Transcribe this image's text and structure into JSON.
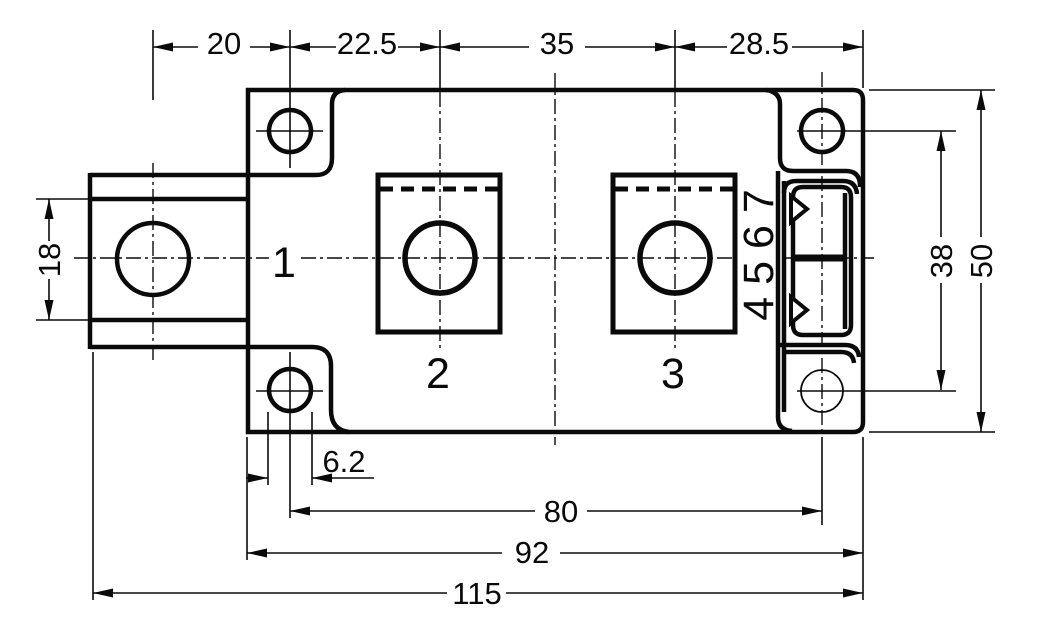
{
  "dimensions": {
    "top": {
      "d1": "20",
      "d2": "22.5",
      "d3": "35",
      "d4": "28.5"
    },
    "left": {
      "d1": "18"
    },
    "right": {
      "d1": "38",
      "d2": "50"
    },
    "bottom": {
      "d1": "6.2",
      "d2": "80",
      "d3": "92",
      "d4": "115"
    }
  },
  "terminals": {
    "t1": "1",
    "t2": "2",
    "t3": "3",
    "pins": "4 5 6 7"
  }
}
